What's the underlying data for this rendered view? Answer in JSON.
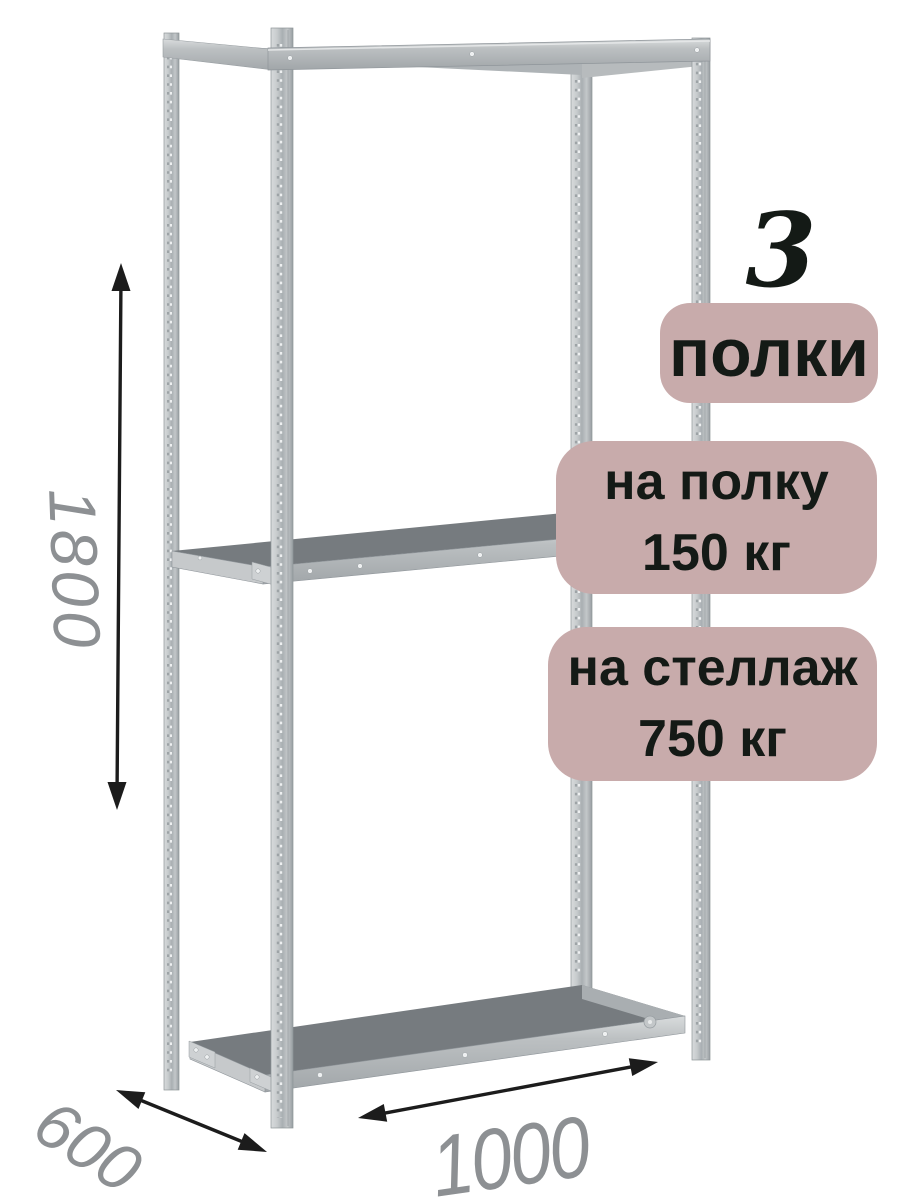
{
  "dimensions": {
    "height": "1800",
    "depth": "600",
    "width": "1000"
  },
  "callouts": {
    "shelf_count_value": "3",
    "shelf_count_label": "полки",
    "shelf_load_line1": "на полку",
    "shelf_load_line2": "150 кг",
    "rack_load_line1": "на стеллаж",
    "rack_load_line2": "750 кг"
  },
  "colors": {
    "background": "#ffffff",
    "badge_background": "#c8abab",
    "badge_text": "#141a16",
    "dimension_text": "#8d9093",
    "arrow": "#1c1c1c",
    "metal_light": "#d6d9da",
    "metal_mid": "#b3b8bb",
    "metal_dark": "#9aa0a4",
    "shelf_surface": "#767b7f"
  }
}
